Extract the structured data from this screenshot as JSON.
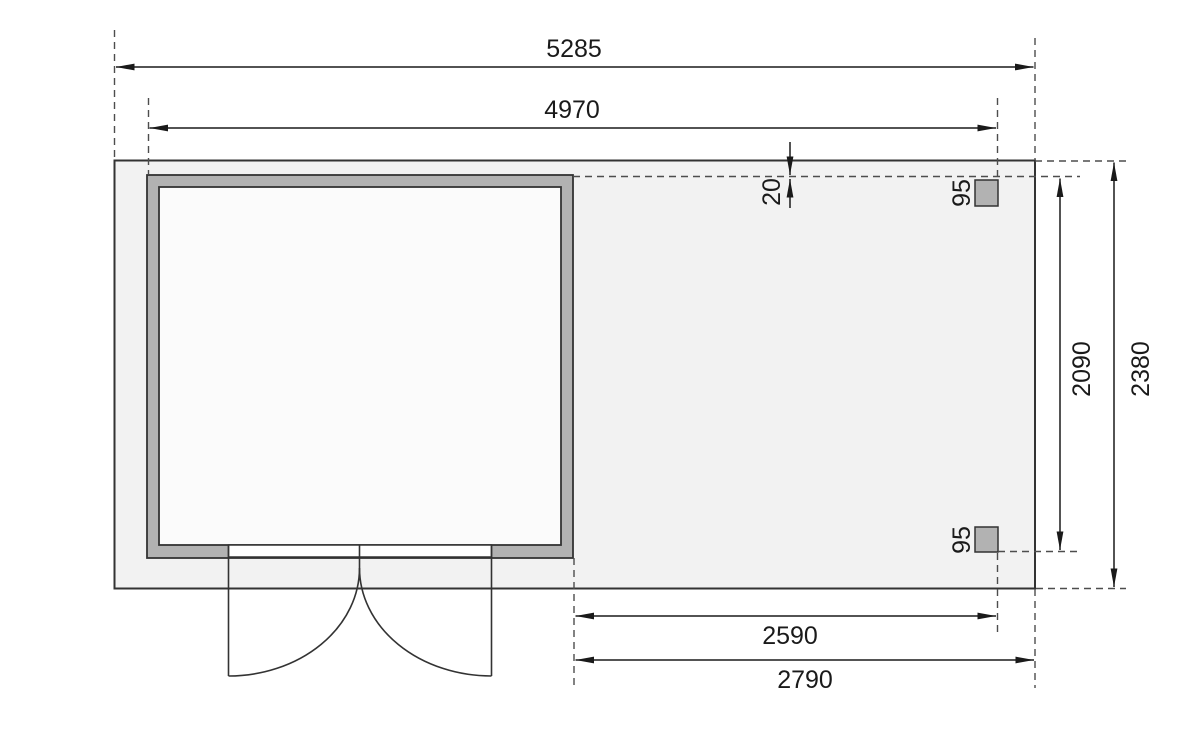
{
  "drawing": {
    "kind": "technical floor plan, top view, shed with side annex roof",
    "dim_labels": {
      "overall_width": "5285",
      "house_width": "4970",
      "edge_offset": "20",
      "post_top": "95",
      "post_bottom": "95",
      "annex_depth_inner": "2090",
      "overall_depth": "2380",
      "annex_width_inner": "2590",
      "annex_width_overall": "2790"
    },
    "colors": {
      "line": "#1a1a1a",
      "outline": "#333333",
      "plate_fill": "#f2f2f2",
      "room_fill": "#fbfbfb",
      "threshold_fill": "#ffffff",
      "wall_fill": "#b2b2b2",
      "dashed": "#4d4d4d",
      "background": "#ffffff"
    }
  }
}
